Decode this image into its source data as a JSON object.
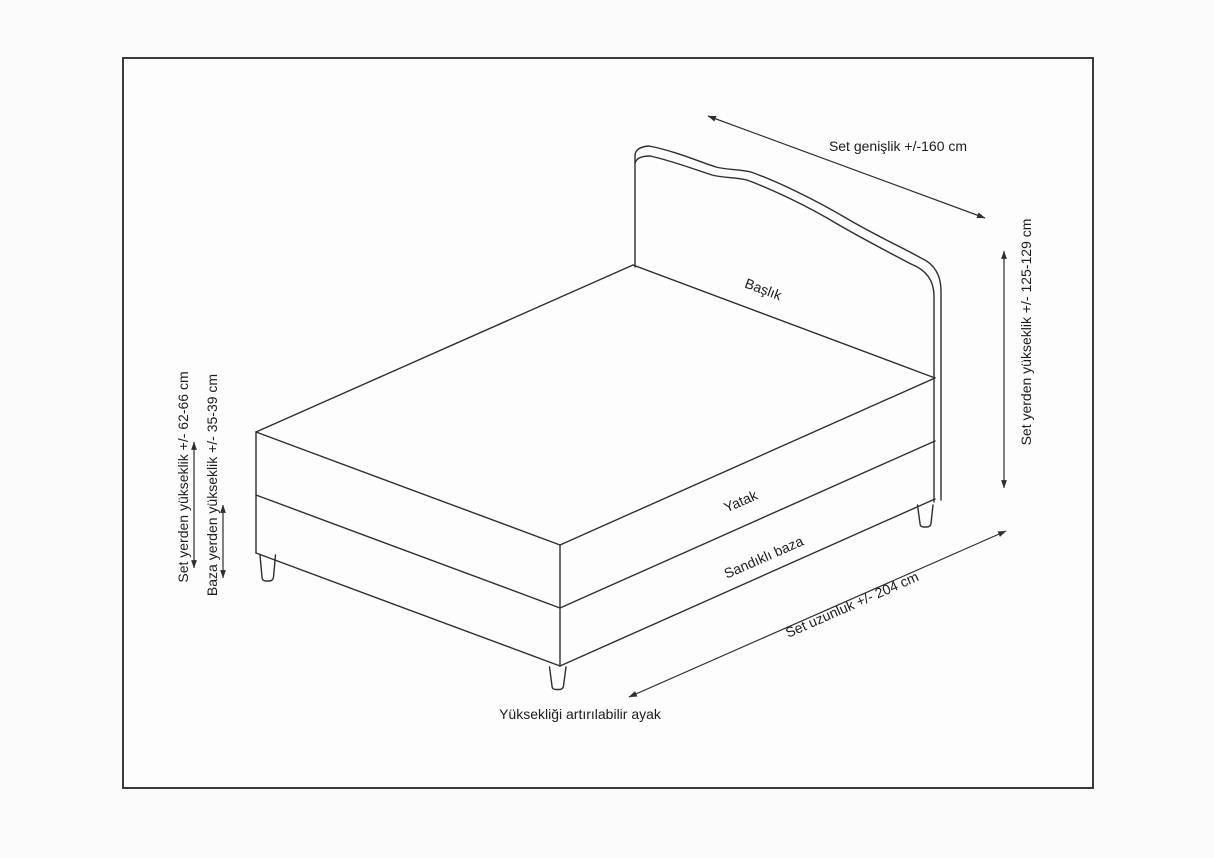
{
  "diagram": {
    "type": "bed-set-dimension-drawing",
    "dimension_labels": {
      "set_width": "Set genişlik +/-160 cm",
      "set_height_total": "Set yerden yükseklik +/- 125-129 cm",
      "set_length": "Set uzunluk +/- 204 cm",
      "set_height_mattress_top": "Set yerden yükseklik +/- 62-66 cm",
      "base_height": "Baza yerden yükseklik +/- 35-39 cm"
    },
    "part_labels": {
      "headboard": "Başlık",
      "mattress": "Yatak",
      "storage_base": "Sandıklı baza",
      "adjustable_leg": "Yüksekliği artırılabilir ayak"
    },
    "colors": {
      "line": "#2e2e2e",
      "text": "#1c1c1c",
      "border": "#3a3a3a",
      "background": "#fbfbfb"
    }
  }
}
